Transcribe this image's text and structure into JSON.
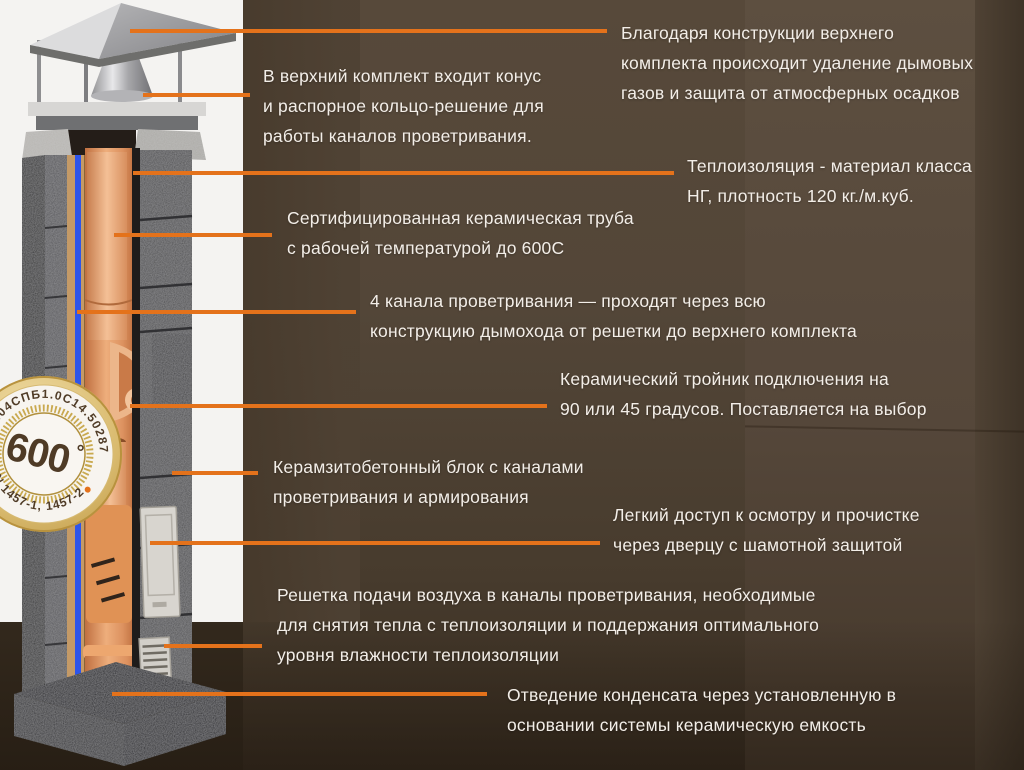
{
  "colors": {
    "accent_orange": "#e4721b",
    "text_color": "#f3eee8",
    "wall_brown": "#534638",
    "panel_white": "#f4f3f1",
    "air_channel_blue": "#2e55ea",
    "ceramic_orange": "#e09a63",
    "badge_gold": "#c9a94f"
  },
  "illustration": {
    "badge": {
      "temperature": "600",
      "degree_symbol": "°",
      "certificate_arc_top": "9.04СПБ1.0С14.50287",
      "certificate_arc_bottom": "EN 1457-1, 1457-2"
    }
  },
  "annotations": [
    {
      "id": "cap-exhaust",
      "lines": [
        "Благодаря конструкции верхнего",
        "комплекта происходит удаление дымовых",
        "газов и защита от атмосферных осадков"
      ]
    },
    {
      "id": "top-kit",
      "lines": [
        "В верхний комплект входит конус",
        "и распорное кольцо-решение для",
        "работы каналов проветривания."
      ]
    },
    {
      "id": "insulation",
      "lines": [
        "Теплоизоляция - материал класса",
        "НГ, плотность 120 кг./м.куб."
      ]
    },
    {
      "id": "ceramic-pipe",
      "lines": [
        "Сертифицированная керамическая труба",
        "с рабочей температурой до 600С"
      ]
    },
    {
      "id": "vent-channels",
      "lines": [
        "4 канала проветривания — проходят через всю",
        "конструкцию дымохода от решетки до верхнего комплекта"
      ]
    },
    {
      "id": "tee-connection",
      "lines": [
        "Керамический тройник подключения на",
        "90 или 45 градусов. Поставляется на выбор"
      ]
    },
    {
      "id": "concrete-block",
      "lines": [
        "Керамзитобетонный блок с каналами",
        "проветривания и армирования"
      ]
    },
    {
      "id": "inspection-door",
      "lines": [
        "Легкий доступ к осмотру и прочистке",
        "через дверцу с шамотной защитой"
      ]
    },
    {
      "id": "air-grille",
      "lines": [
        "Решетка подачи воздуха в каналы проветривания, необходимые",
        "для снятия тепла с теплоизоляции и поддержания оптимального",
        "уровня влажности теплоизоляции"
      ]
    },
    {
      "id": "condensate",
      "lines": [
        "Отведение конденсата через установленную в",
        "основании системы керамическую емкость"
      ]
    }
  ]
}
